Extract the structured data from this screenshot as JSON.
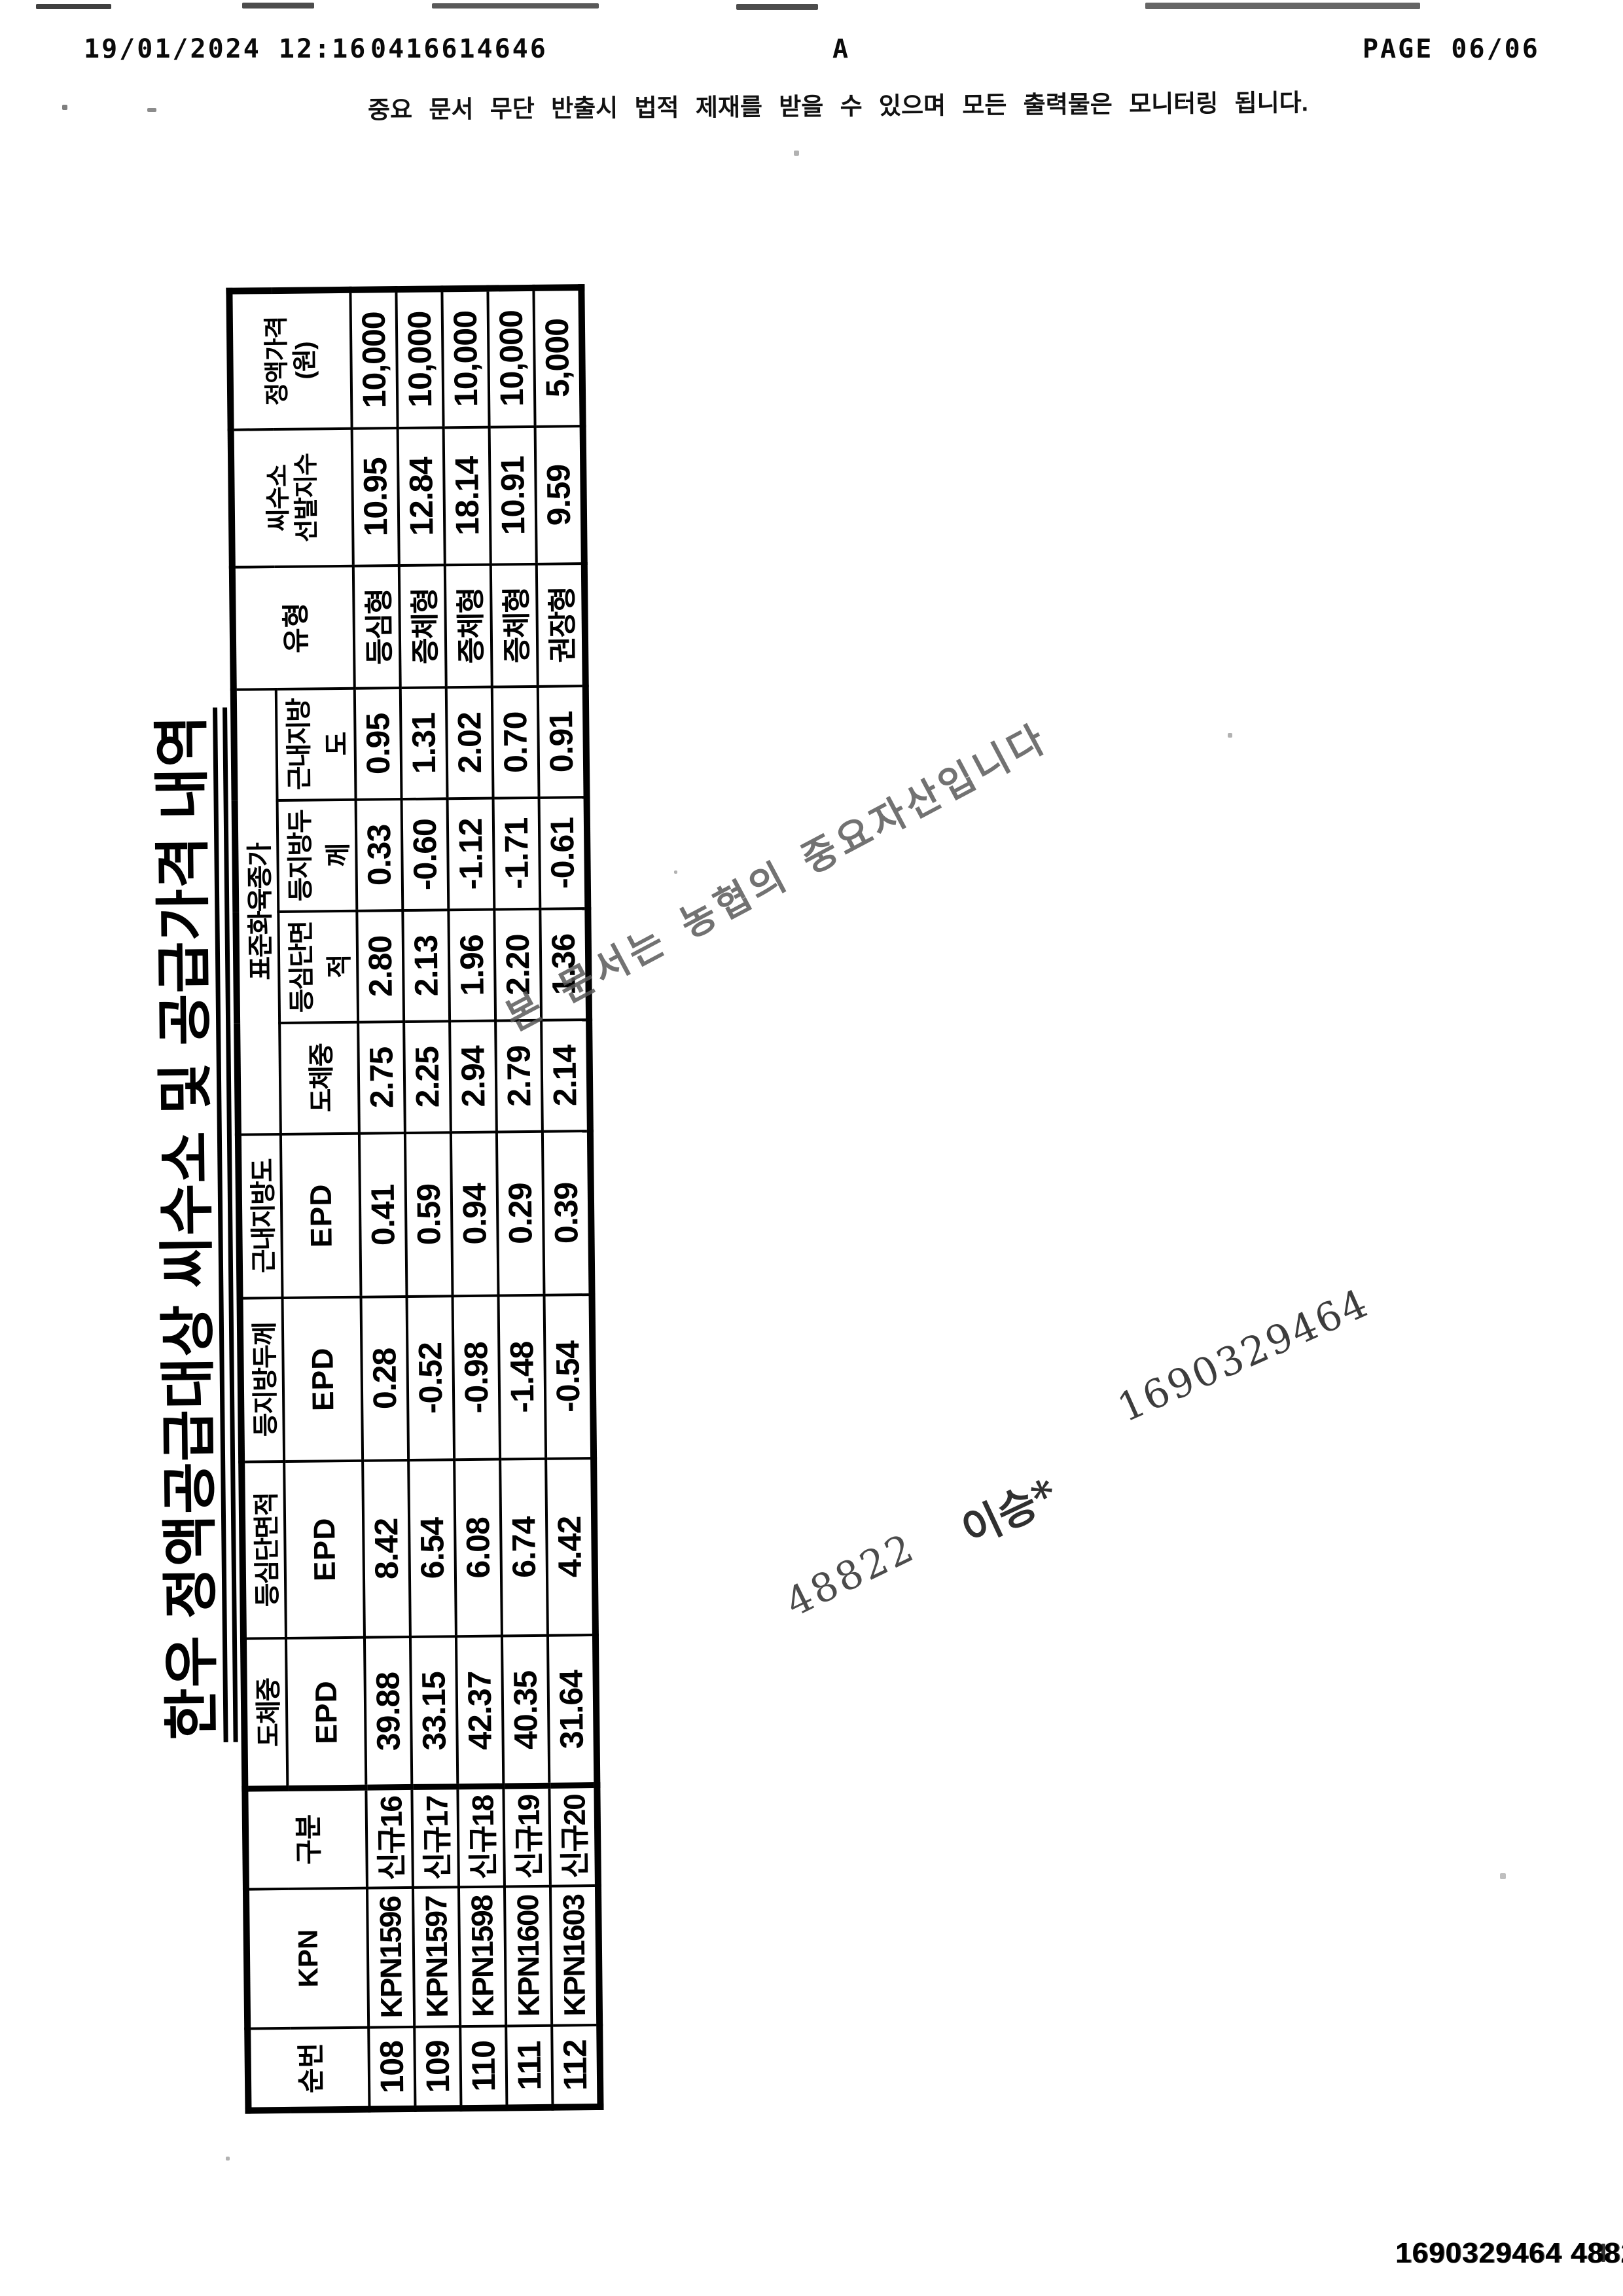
{
  "fax_header": {
    "date_time": "19/01/2024  12:16",
    "fax_id": "0416614646",
    "mode": "A",
    "page": "PAGE  06/06"
  },
  "notice": "중요 문서 무단 반출시 법적 제재를 받을 수 있으며 모든 출력물은 모니터링 됩니다.",
  "document": {
    "title": "한우 정액공급대상 씨수소 및 공급가격 내역",
    "table": {
      "headers": {
        "seq": "순번",
        "kpn": "KPN",
        "category": "구분",
        "epd_cols": [
          {
            "trait": "도체중",
            "sub": "EPD"
          },
          {
            "trait": "등심단면적",
            "sub": "EPD"
          },
          {
            "trait": "등지방두께",
            "sub": "EPD"
          },
          {
            "trait": "근내지방도",
            "sub": "EPD"
          }
        ],
        "std_group": {
          "label": "표준화육종가",
          "subs": [
            "도체중",
            "등심단면적",
            "등지방두께",
            "근내지방도"
          ]
        },
        "type": "유형",
        "index_line1": "씨수소",
        "index_line2": "선발지수",
        "price_line1": "정액가격",
        "price_line2": "(원)"
      },
      "rows": [
        {
          "seq": "108",
          "kpn": "KPN1596",
          "category": "신규16",
          "epd": [
            "39.88",
            "8.42",
            "0.28",
            "0.41"
          ],
          "std": [
            "2.75",
            "2.80",
            "0.33",
            "0.95"
          ],
          "type": "등심형",
          "index": "10.95",
          "price": "10,000"
        },
        {
          "seq": "109",
          "kpn": "KPN1597",
          "category": "신규17",
          "epd": [
            "33.15",
            "6.54",
            "-0.52",
            "0.59"
          ],
          "std": [
            "2.25",
            "2.13",
            "-0.60",
            "1.31"
          ],
          "type": "증체형",
          "index": "12.84",
          "price": "10,000"
        },
        {
          "seq": "110",
          "kpn": "KPN1598",
          "category": "신규18",
          "epd": [
            "42.37",
            "6.08",
            "-0.98",
            "0.94"
          ],
          "std": [
            "2.94",
            "1.96",
            "-1.12",
            "2.02"
          ],
          "type": "증체형",
          "index": "18.14",
          "price": "10,000"
        },
        {
          "seq": "111",
          "kpn": "KPN1600",
          "category": "신규19",
          "epd": [
            "40.35",
            "6.74",
            "-1.48",
            "0.29"
          ],
          "std": [
            "2.79",
            "2.20",
            "-1.71",
            "0.70"
          ],
          "type": "증체형",
          "index": "10.91",
          "price": "10,000"
        },
        {
          "seq": "112",
          "kpn": "KPN1603",
          "category": "신규20",
          "epd": [
            "31.64",
            "4.42",
            "-0.54",
            "0.39"
          ],
          "std": [
            "2.14",
            "1.36",
            "-0.61",
            "0.91"
          ],
          "type": "권장형",
          "index": "9.59",
          "price": "5,000"
        }
      ]
    }
  },
  "watermark": "본 문서는 농협의 중요자산입니다",
  "annotations": {
    "serial": "1690329464",
    "name": "이승*",
    "code": "48822"
  },
  "footer": {
    "serial_code": "1690329464 48822"
  }
}
